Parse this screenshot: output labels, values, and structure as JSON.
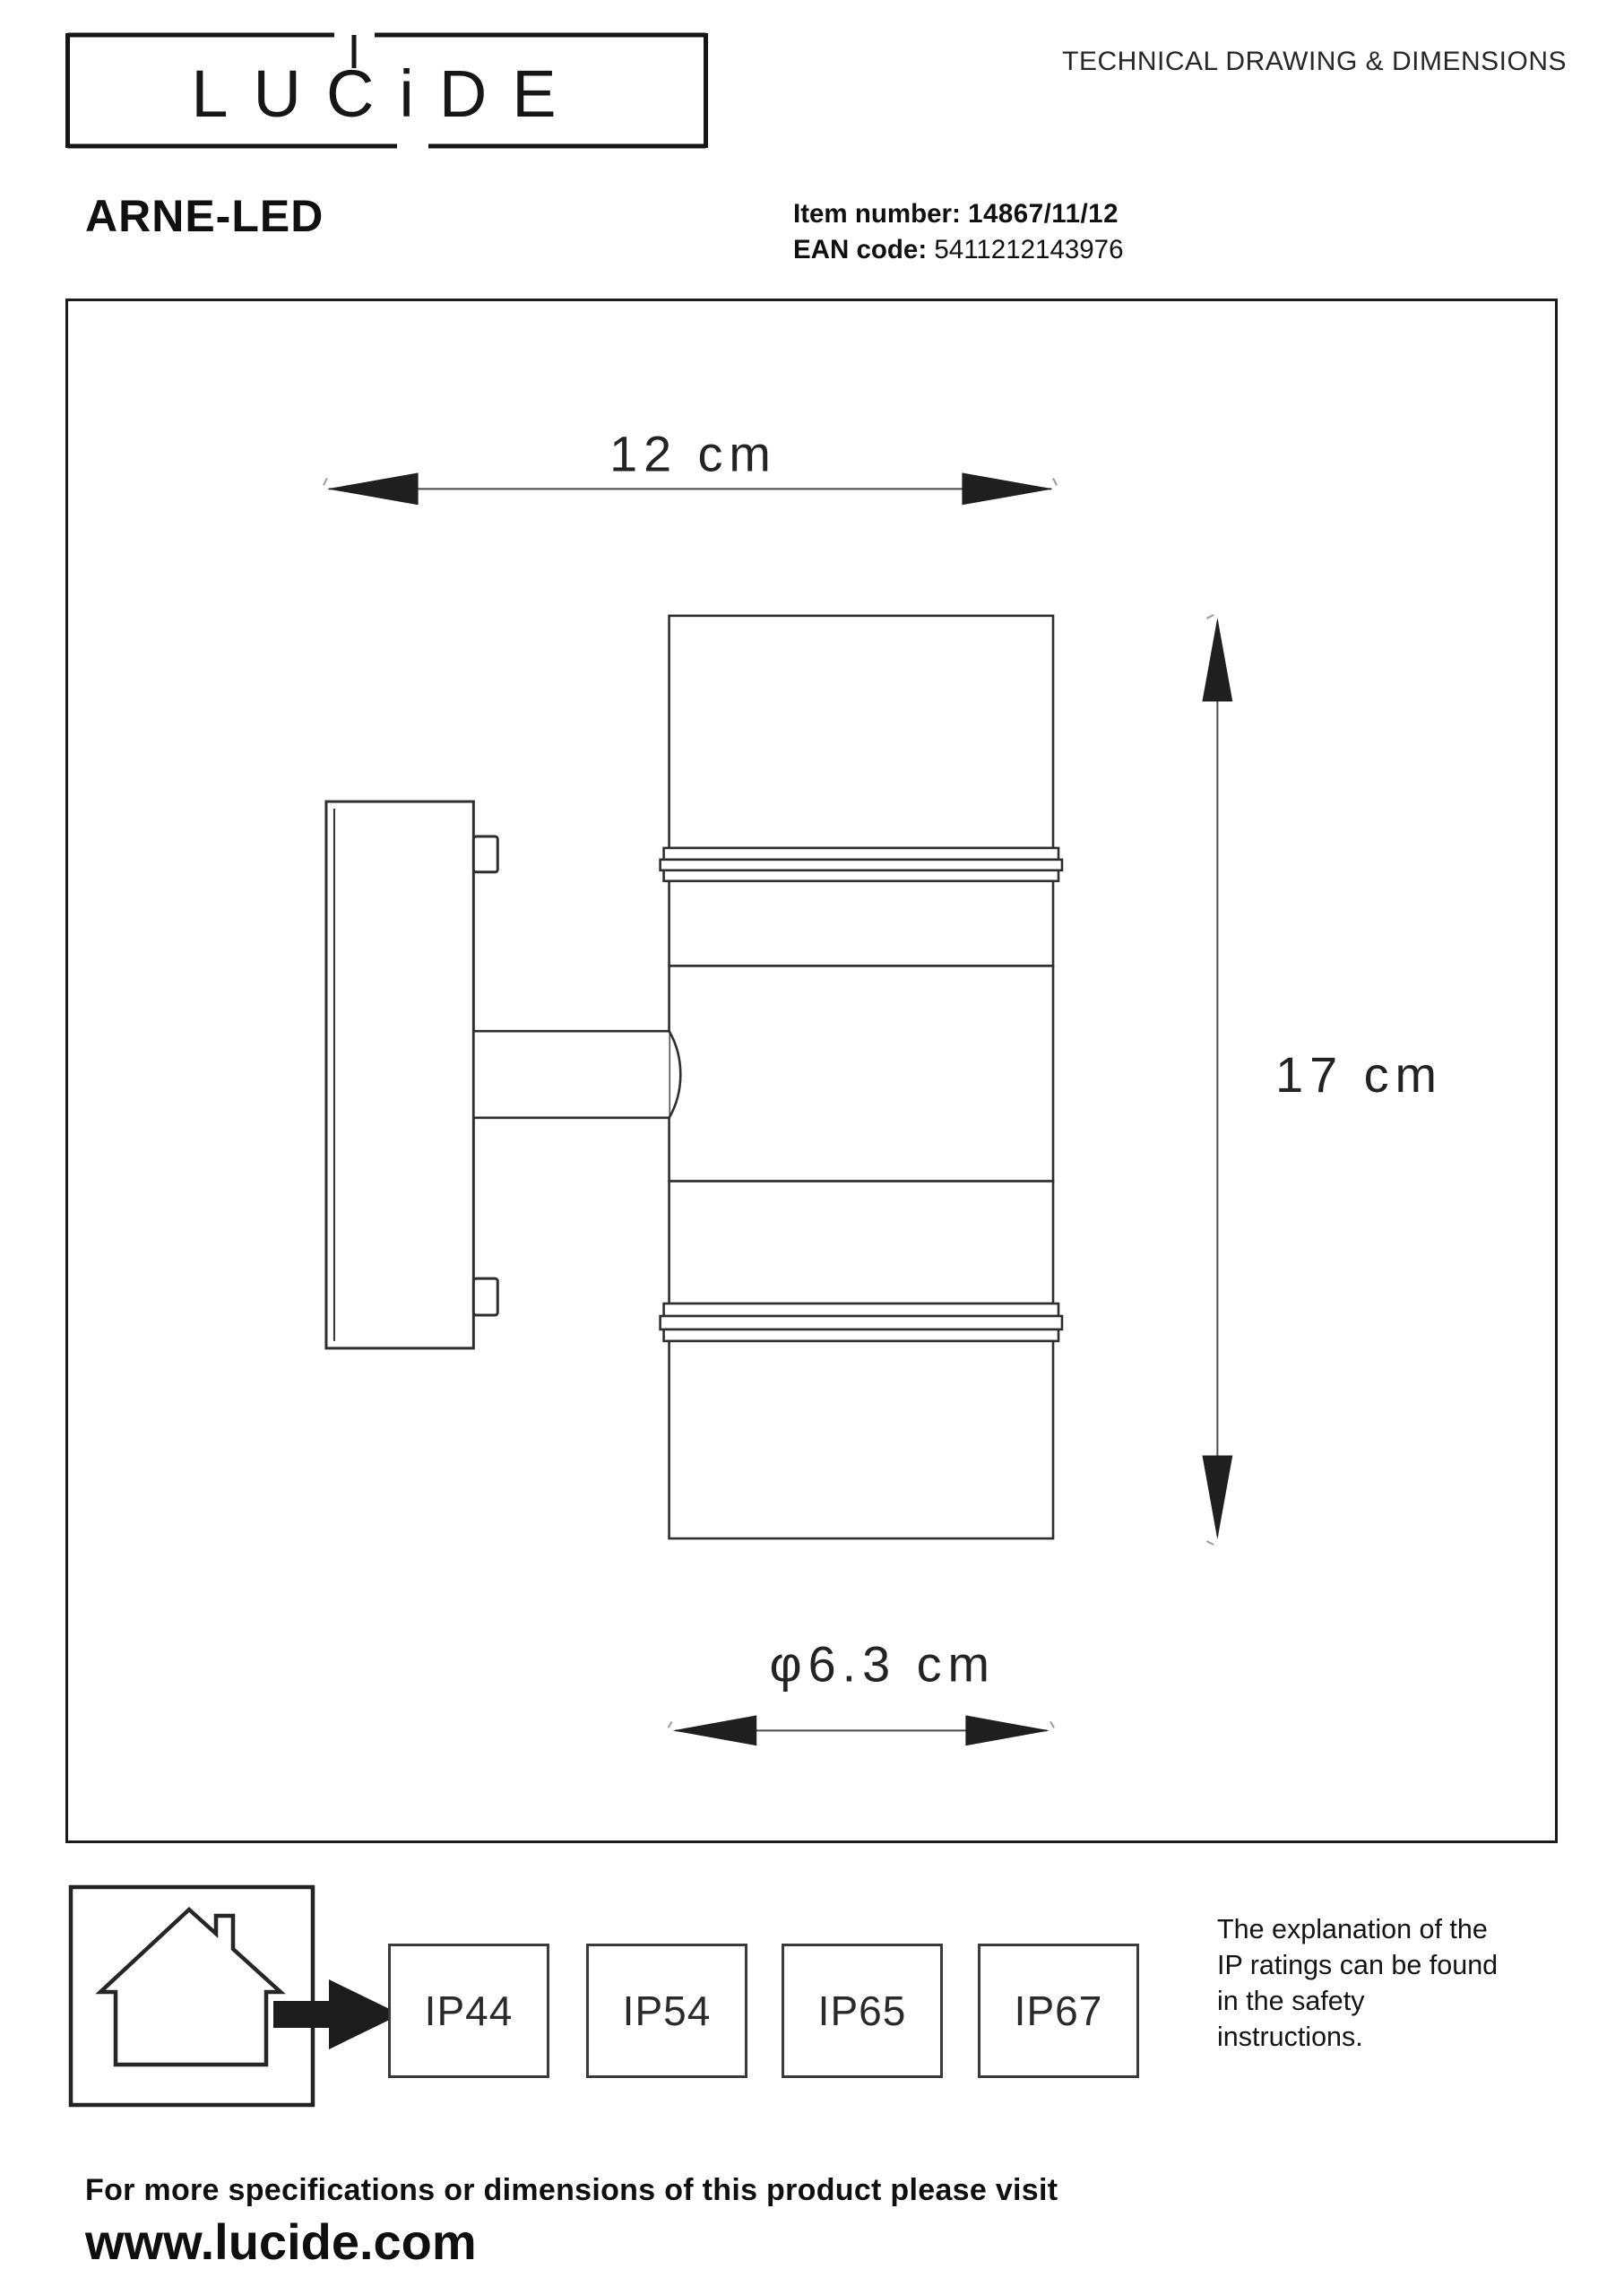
{
  "header": {
    "logo_text": "LUCiDE",
    "tagline": "TECHNICAL DRAWING & DIMENSIONS"
  },
  "product": {
    "name": "ARNE-LED",
    "item_label": "Item number:",
    "item_value": "14867/11/12",
    "ean_label": "EAN code:",
    "ean_value": "5411212143976"
  },
  "drawing": {
    "width_dim": "12 cm",
    "height_dim": "17 cm",
    "diameter_dim": "φ6.3 cm"
  },
  "ip": {
    "ratings": [
      "IP44",
      "IP54",
      "IP65",
      "IP67"
    ],
    "note": "The explanation of the\nIP ratings can be found\nin the safety\ninstructions."
  },
  "footer": {
    "line1": "For more specifications or dimensions of this product please visit",
    "line2": "www.lucide.com"
  },
  "colors": {
    "ink": "#1a1a1a",
    "line": "#2e2e2e",
    "arrow": "#1f1f1f"
  }
}
